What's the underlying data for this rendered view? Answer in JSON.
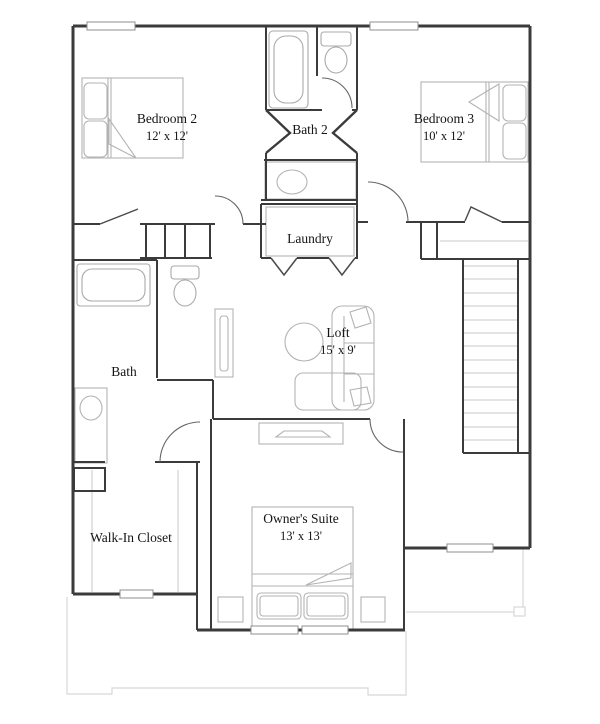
{
  "floor_plan": {
    "rooms": [
      {
        "id": "bedroom-2",
        "name": "Bedroom 2",
        "dims": "12' x 12'"
      },
      {
        "id": "bath-2",
        "name": "Bath 2",
        "dims": ""
      },
      {
        "id": "bedroom-3",
        "name": "Bedroom 3",
        "dims": "10' x 12'"
      },
      {
        "id": "laundry",
        "name": "Laundry",
        "dims": ""
      },
      {
        "id": "bath",
        "name": "Bath",
        "dims": ""
      },
      {
        "id": "loft",
        "name": "Loft",
        "dims": "15' x 9'"
      },
      {
        "id": "walk-in-closet",
        "name": "Walk-In Closet",
        "dims": ""
      },
      {
        "id": "owners-suite",
        "name": "Owner's Suite",
        "dims": "13' x 13'"
      }
    ],
    "colors": {
      "wall": "#3b3b3b",
      "door": "#666666",
      "furniture": "#b3b3b3",
      "treads": "#c9c9c9",
      "faint_outline": "#d7d7d7",
      "text": "#141414",
      "background": "#ffffff"
    }
  }
}
